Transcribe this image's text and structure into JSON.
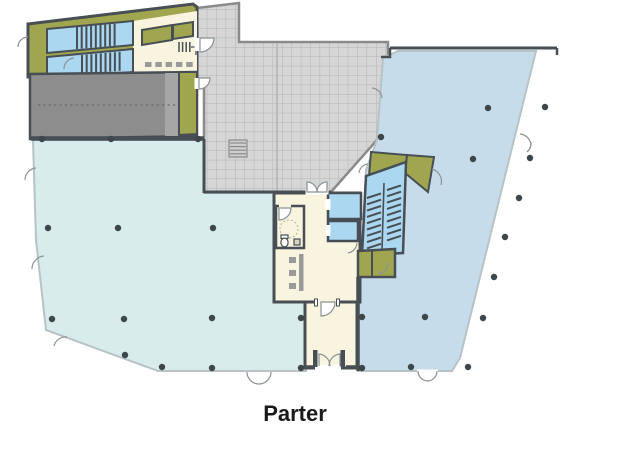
{
  "title": {
    "text": "Parter"
  },
  "areas": {
    "left_open_space": "large open-plan area (left)",
    "right_open_space": "large open-plan area (right)",
    "courtyard_terrace": "tiled courtyard / terrace",
    "parking_ramp": "ramp",
    "stair_core": "staircase core with elevators",
    "entrance_vestibule": "entrance vestibule",
    "lobby": "lobby with reception desk and WC",
    "north_stair_block": "north staircase block"
  },
  "colors": {
    "background": "#ffffff",
    "open-space-left": "#d8ecec",
    "open-space-right": "#c6dcea",
    "stair-blue": "#abd7f0",
    "olive": "#a0a650",
    "cream": "#f8f4df",
    "grid-fill": "#d6d6d6",
    "grid-line": "#b4b4b4",
    "grid-border": "#8a8a8a",
    "ramp-dark": "#8d8d8d",
    "ramp-light": "#a6a6a6",
    "wall-dark": "#474f54",
    "wall-light": "#b7c3c7",
    "column": "#3d464b",
    "door": "#8a9296",
    "desk-gray": "#9a9a9a",
    "label": "#1a1a1a"
  }
}
